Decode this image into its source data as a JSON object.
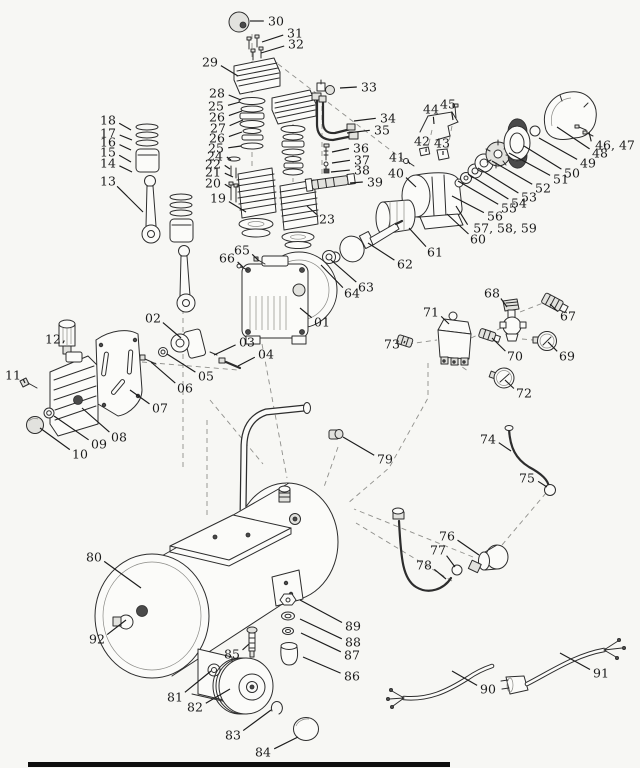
{
  "diagram": {
    "background": "#f7f7f4",
    "line_color": "#2d2d2d",
    "label_color": "#1b1b1b",
    "bottom_bar_color": "#0e0e0e",
    "callouts": [
      {
        "label": "01",
        "x": 322,
        "y": 322,
        "px": 300,
        "py": 308
      },
      {
        "label": "02",
        "x": 153,
        "y": 318,
        "px": 181,
        "py": 338
      },
      {
        "label": "03",
        "x": 247,
        "y": 342,
        "px": 214,
        "py": 355
      },
      {
        "label": "04",
        "x": 266,
        "y": 354,
        "px": 238,
        "py": 366
      },
      {
        "label": "05",
        "x": 206,
        "y": 376,
        "px": 167,
        "py": 354
      },
      {
        "label": "06",
        "x": 185,
        "y": 388,
        "px": 151,
        "py": 362
      },
      {
        "label": "07",
        "x": 160,
        "y": 408,
        "px": 130,
        "py": 390
      },
      {
        "label": "08",
        "x": 119,
        "y": 437,
        "px": 82,
        "py": 408
      },
      {
        "label": "09",
        "x": 99,
        "y": 444,
        "px": 54,
        "py": 416
      },
      {
        "label": "10",
        "x": 80,
        "y": 454,
        "px": 40,
        "py": 428
      },
      {
        "label": "11",
        "x": 13,
        "y": 375,
        "px": 25,
        "py": 383
      },
      {
        "label": "12",
        "x": 53,
        "y": 339,
        "px": 63,
        "py": 343
      },
      {
        "label": "13",
        "x": 108,
        "y": 181,
        "px": 143,
        "py": 212
      },
      {
        "label": "14",
        "x": 108,
        "y": 163,
        "px": 132,
        "py": 172
      },
      {
        "label": "15",
        "x": 108,
        "y": 152,
        "px": 131,
        "py": 162
      },
      {
        "label": "16",
        "x": 108,
        "y": 142,
        "px": 131,
        "py": 150
      },
      {
        "label": "17",
        "x": 108,
        "y": 133,
        "px": 132,
        "py": 140
      },
      {
        "label": "18",
        "x": 108,
        "y": 120,
        "px": 131,
        "py": 130
      },
      {
        "label": "19",
        "x": 218,
        "y": 198,
        "px": 246,
        "py": 212
      },
      {
        "label": "20",
        "x": 213,
        "y": 183,
        "px": 231,
        "py": 188
      },
      {
        "label": "21",
        "x": 213,
        "y": 172,
        "px": 233,
        "py": 177
      },
      {
        "label": "22",
        "x": 213,
        "y": 164,
        "px": 230,
        "py": 169
      },
      {
        "label": "23",
        "x": 327,
        "y": 219,
        "px": 307,
        "py": 206
      },
      {
        "label": "24",
        "x": 215,
        "y": 156,
        "px": 231,
        "py": 160
      },
      {
        "label": "25",
        "x": 216,
        "y": 106,
        "px": 240,
        "py": 102
      },
      {
        "label": "26",
        "x": 217,
        "y": 117,
        "px": 242,
        "py": 111
      },
      {
        "label": "27",
        "x": 218,
        "y": 128,
        "px": 243,
        "py": 120
      },
      {
        "label": "26",
        "x": 217,
        "y": 138,
        "px": 242,
        "py": 132
      },
      {
        "label": "25",
        "x": 216,
        "y": 148,
        "px": 241,
        "py": 146
      },
      {
        "label": "28",
        "x": 217,
        "y": 93,
        "px": 241,
        "py": 100
      },
      {
        "label": "29",
        "x": 210,
        "y": 62,
        "px": 238,
        "py": 76
      },
      {
        "label": "30",
        "x": 276,
        "y": 21,
        "px": 250,
        "py": 21
      },
      {
        "label": "31",
        "x": 295,
        "y": 33,
        "px": 262,
        "py": 42
      },
      {
        "label": "32",
        "x": 296,
        "y": 44,
        "px": 261,
        "py": 53
      },
      {
        "label": "33",
        "x": 369,
        "y": 87,
        "px": 340,
        "py": 88
      },
      {
        "label": "34",
        "x": 388,
        "y": 118,
        "px": 354,
        "py": 121
      },
      {
        "label": "35",
        "x": 382,
        "y": 130,
        "px": 347,
        "py": 133
      },
      {
        "label": "36",
        "x": 361,
        "y": 148,
        "px": 332,
        "py": 152
      },
      {
        "label": "37",
        "x": 362,
        "y": 160,
        "px": 332,
        "py": 163
      },
      {
        "label": "38",
        "x": 362,
        "y": 170,
        "px": 331,
        "py": 172
      },
      {
        "label": "39",
        "x": 375,
        "y": 182,
        "px": 350,
        "py": 183
      },
      {
        "label": "40",
        "x": 396,
        "y": 173,
        "px": 416,
        "py": 187
      },
      {
        "label": "41",
        "x": 397,
        "y": 157,
        "px": 410,
        "py": 164
      },
      {
        "label": "42",
        "x": 422,
        "y": 141,
        "px": 426,
        "py": 152
      },
      {
        "label": "43",
        "x": 442,
        "y": 143,
        "px": 443,
        "py": 155
      },
      {
        "label": "44",
        "x": 431,
        "y": 109,
        "px": 434,
        "py": 124
      },
      {
        "label": "45",
        "x": 448,
        "y": 104,
        "px": 453,
        "py": 120
      },
      {
        "label": "46, 47",
        "x": 615,
        "y": 145,
        "px": 589,
        "py": 132
      },
      {
        "label": "48",
        "x": 600,
        "y": 153,
        "px": 557,
        "py": 127
      },
      {
        "label": "49",
        "x": 588,
        "y": 163,
        "px": 539,
        "py": 138
      },
      {
        "label": "50",
        "x": 572,
        "y": 173,
        "px": 524,
        "py": 146
      },
      {
        "label": "51",
        "x": 561,
        "y": 179,
        "px": 509,
        "py": 153
      },
      {
        "label": "52",
        "x": 543,
        "y": 188,
        "px": 492,
        "py": 161
      },
      {
        "label": "53",
        "x": 529,
        "y": 197,
        "px": 478,
        "py": 168
      },
      {
        "label": "54",
        "x": 519,
        "y": 203,
        "px": 468,
        "py": 174
      },
      {
        "label": "55",
        "x": 509,
        "y": 208,
        "px": 458,
        "py": 181
      },
      {
        "label": "56",
        "x": 495,
        "y": 216,
        "px": 452,
        "py": 196
      },
      {
        "label": "57, 58, 59",
        "x": 505,
        "y": 228,
        "px": 456,
        "py": 206
      },
      {
        "label": "60",
        "x": 478,
        "y": 239,
        "px": 447,
        "py": 214
      },
      {
        "label": "61",
        "x": 435,
        "y": 252,
        "px": 409,
        "py": 228
      },
      {
        "label": "62",
        "x": 405,
        "y": 264,
        "px": 368,
        "py": 243
      },
      {
        "label": "63",
        "x": 366,
        "y": 287,
        "px": 331,
        "py": 260
      },
      {
        "label": "64",
        "x": 352,
        "y": 293,
        "px": 321,
        "py": 265
      },
      {
        "label": "65",
        "x": 242,
        "y": 250,
        "px": 259,
        "py": 261
      },
      {
        "label": "66",
        "x": 227,
        "y": 258,
        "px": 243,
        "py": 267
      },
      {
        "label": "67",
        "x": 568,
        "y": 316,
        "px": 550,
        "py": 304
      },
      {
        "label": "68",
        "x": 492,
        "y": 293,
        "px": 507,
        "py": 307
      },
      {
        "label": "69",
        "x": 567,
        "y": 356,
        "px": 548,
        "py": 342
      },
      {
        "label": "70",
        "x": 515,
        "y": 356,
        "px": 492,
        "py": 338
      },
      {
        "label": "71",
        "x": 431,
        "y": 312,
        "px": 449,
        "py": 324
      },
      {
        "label": "72",
        "x": 524,
        "y": 393,
        "px": 505,
        "py": 380
      },
      {
        "label": "73",
        "x": 392,
        "y": 344,
        "px": 405,
        "py": 341
      },
      {
        "label": "74",
        "x": 488,
        "y": 439,
        "px": 511,
        "py": 451
      },
      {
        "label": "75",
        "x": 527,
        "y": 478,
        "px": 547,
        "py": 487
      },
      {
        "label": "76",
        "x": 447,
        "y": 536,
        "px": 479,
        "py": 555
      },
      {
        "label": "77",
        "x": 438,
        "y": 550,
        "px": 455,
        "py": 567
      },
      {
        "label": "78",
        "x": 424,
        "y": 565,
        "px": 446,
        "py": 579
      },
      {
        "label": "79",
        "x": 385,
        "y": 459,
        "px": 343,
        "py": 437
      },
      {
        "label": "80",
        "x": 94,
        "y": 557,
        "px": 141,
        "py": 588
      },
      {
        "label": "81",
        "x": 175,
        "y": 697,
        "px": 211,
        "py": 671
      },
      {
        "label": "82",
        "x": 195,
        "y": 707,
        "px": 230,
        "py": 689
      },
      {
        "label": "83",
        "x": 233,
        "y": 735,
        "px": 271,
        "py": 710
      },
      {
        "label": "84",
        "x": 263,
        "y": 752,
        "px": 298,
        "py": 737
      },
      {
        "label": "85",
        "x": 232,
        "y": 654,
        "px": 249,
        "py": 644
      },
      {
        "label": "86",
        "x": 352,
        "y": 676,
        "px": 303,
        "py": 657
      },
      {
        "label": "87",
        "x": 352,
        "y": 655,
        "px": 301,
        "py": 633
      },
      {
        "label": "88",
        "x": 353,
        "y": 642,
        "px": 300,
        "py": 619
      },
      {
        "label": "89",
        "x": 353,
        "y": 626,
        "px": 300,
        "py": 600
      },
      {
        "label": "90",
        "x": 488,
        "y": 689,
        "px": 452,
        "py": 671
      },
      {
        "label": "91",
        "x": 601,
        "y": 673,
        "px": 560,
        "py": 653
      },
      {
        "label": "92",
        "x": 97,
        "y": 639,
        "px": 126,
        "py": 620
      }
    ]
  }
}
